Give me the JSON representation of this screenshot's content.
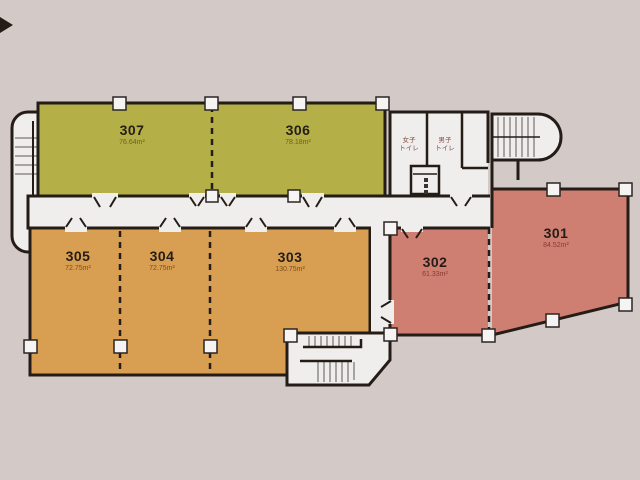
{
  "rooms": {
    "301": {
      "number": "301",
      "area": "84.52m²"
    },
    "302": {
      "number": "302",
      "area": "61.33m²"
    },
    "303": {
      "number": "303",
      "area": "130.75m²"
    },
    "304": {
      "number": "304",
      "area": "72.75m²"
    },
    "305": {
      "number": "305",
      "area": "72.75m²"
    },
    "306": {
      "number": "306",
      "area": "78.18m²"
    },
    "307": {
      "number": "307",
      "area": "76.64m²"
    }
  },
  "facilities": {
    "women_toilet": {
      "line1": "女子",
      "line2": "トイレ"
    },
    "men_toilet": {
      "line1": "男子",
      "line2": "トイレ"
    }
  },
  "colors": {
    "green_rooms": "#b4b047",
    "orange_rooms": "#d89f52",
    "red_rooms": "#cf7e72",
    "walls": "#241c16",
    "floor_white": "#f0eeec",
    "background": "#d3cac8"
  }
}
